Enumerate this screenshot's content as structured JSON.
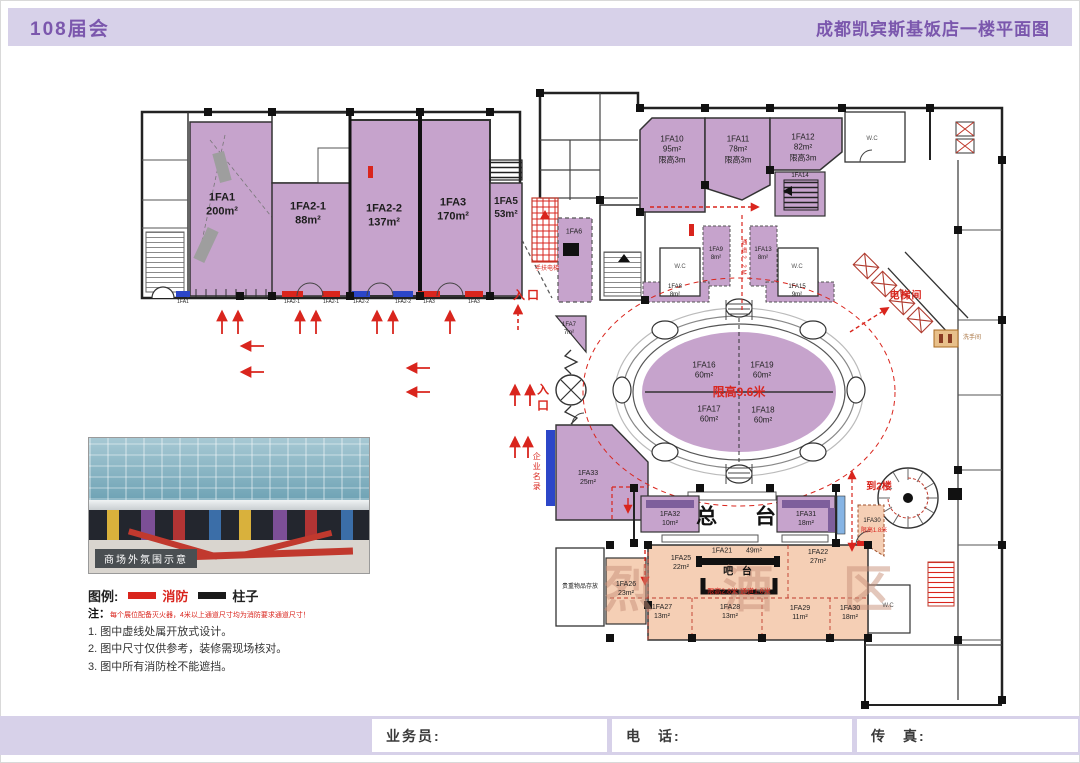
{
  "header": {
    "left_title": "108届会",
    "right_title": "成都凯宾斯基饭店一楼平面图"
  },
  "rooms": {
    "fa1": "1FA1\n200m²",
    "fa2_1": "1FA2-1\n88m²",
    "fa2_2": "1FA2-2\n137m²",
    "fa3": "1FA3\n170m²",
    "fa5": "1FA5\n53m²",
    "fa6": "1FA6",
    "fa7": "1FA7\n7m²",
    "fa8": "1FA8\n8m²",
    "fa9": "1FA9\n8m²",
    "fa10": "1FA10\n95m²\n限高3m",
    "fa11": "1FA11\n78m²\n限高3m",
    "fa12": "1FA12\n82m²\n限高3m",
    "fa13": "1FA13\n8m²",
    "fa14": "1FA14",
    "fa15": "1FA15\n9m²",
    "fa16": "1FA16\n60m²",
    "fa17": "1FA17\n60m²",
    "fa18": "1FA18\n60m²",
    "fa19": "1FA19\n60m²",
    "fa21": "1FA21",
    "fa21_area": "49m²",
    "fa22": "1FA22\n27m²",
    "fa25": "1FA25\n22m²",
    "fa26": "1FA26\n23m²",
    "fa27": "1FA27\n13m²",
    "fa28": "1FA28\n13m²",
    "fa29": "1FA29\n11m²",
    "fa30": "1FA30\n18m²",
    "fa30b": "1FA30",
    "fa31": "1FA31\n18m²",
    "fa32": "1FA32\n10m²",
    "fa33": "1FA33\n25m²"
  },
  "strips": [
    "1FA1",
    "1FA2-1",
    "1FA2-1",
    "1FA2-2",
    "1FA2-2",
    "1FA3",
    "1FA3"
  ],
  "labels": {
    "entrance": "入口",
    "entrance_mid": "入\n口",
    "escalator": "手扶电梯",
    "corridor": "通道2.2M",
    "elevator_hall": "电梯间",
    "restroom_sign": "洗手间",
    "to_2f": "到2楼",
    "front_desk": "总  台",
    "bar_counter": "吧 台",
    "company_directory": "企业名录",
    "valuables": "贵重物品存放",
    "oval_limit": "限高9.6米",
    "fa30_note": "限高1.8米",
    "bar_limit": "限高2.8米  通道1.8米",
    "spirits_zone": "烈 酒 区",
    "wc": "W.C",
    "photo_caption": "商场外氛围示意"
  },
  "legend": {
    "title": "图例:",
    "fire": "消防",
    "pillar": "柱子"
  },
  "notes": {
    "prefix": "注：",
    "red_note": "每个展位配备灭火器，4米以上通道尺寸均为消防要求通道尺寸！",
    "n1": "1. 图中虚线处属开放式设计。",
    "n2": "2. 图中尺寸仅供参考，装修需现场核对。",
    "n3": "3. 图中所有消防栓不能遮挡。"
  },
  "footer": {
    "salesman": "业务员:",
    "phone": "电　话:",
    "fax": "传　真:"
  },
  "colors": {
    "accent_purple": "#7b57ad",
    "room_purple": "#c6a3cc",
    "room_salmon": "#f5cfb5",
    "fire_red": "#d9251d",
    "pillar_black": "#1a1a1a",
    "band_lavender": "#d7d1e9"
  }
}
